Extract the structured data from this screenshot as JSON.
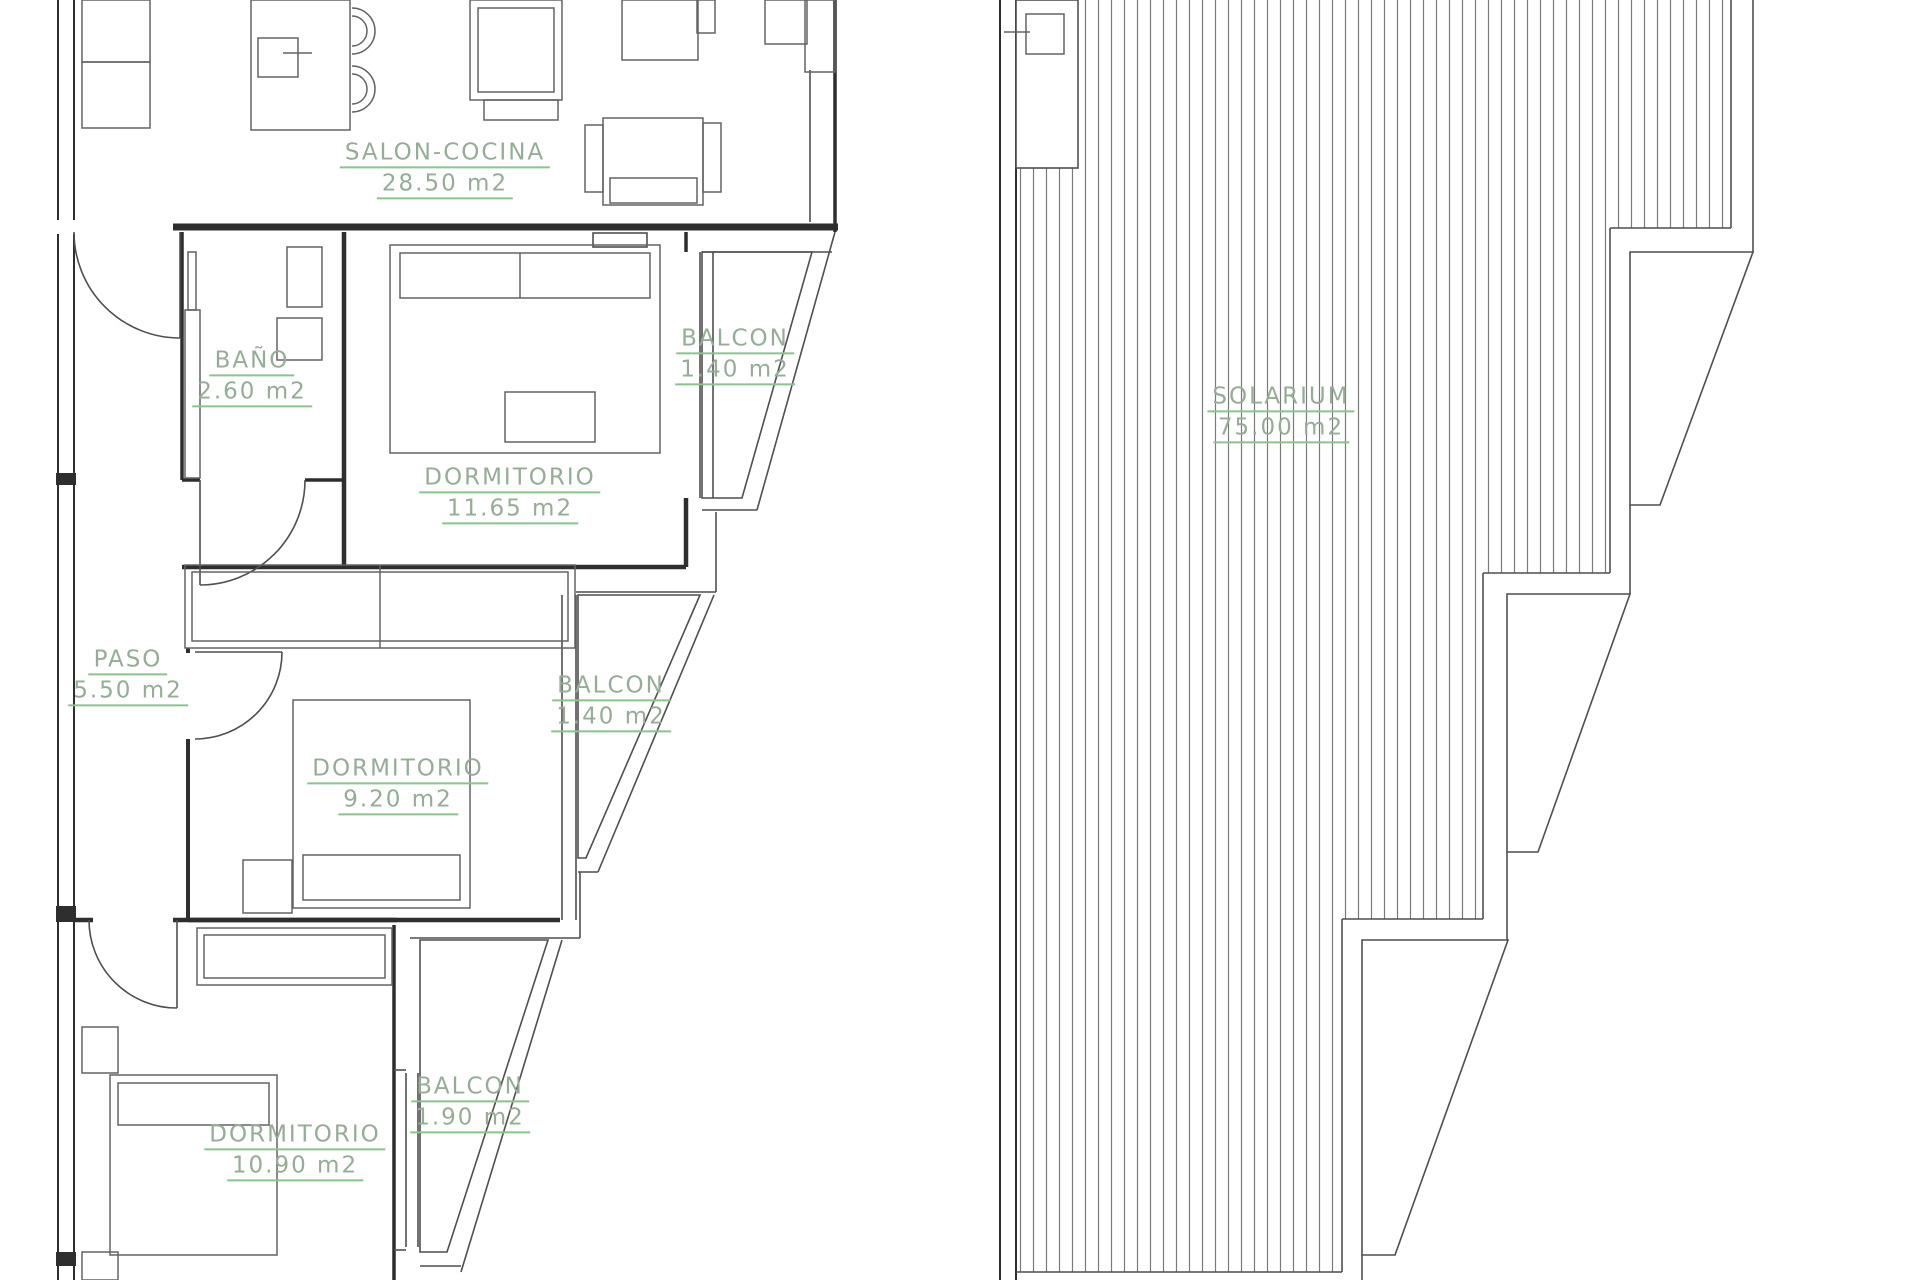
{
  "colors": {
    "label_green": "#8ac48c",
    "label_text": "#95ad95",
    "line_gray": "#4f4f4f",
    "wall_dark": "#2e2e2e",
    "background": "#ffffff"
  },
  "apartment_plan": {
    "salon": {
      "name": "SALON-COCINA",
      "area": "28.50 m2"
    },
    "bathroom": {
      "name": "BAÑO",
      "area": "2.60 m2"
    },
    "bedroom_1": {
      "name": "DORMITORIO",
      "area": "11.65 m2"
    },
    "balcony_1": {
      "name": "BALCON",
      "area": "1.40 m2"
    },
    "hallway": {
      "name": "PASO",
      "area": "5.50 m2"
    },
    "bedroom_2": {
      "name": "DORMITORIO",
      "area": "9.20 m2"
    },
    "balcony_2": {
      "name": "BALCON",
      "area": "1.40 m2"
    },
    "bedroom_3": {
      "name": "DORMITORIO",
      "area": "10.90 m2"
    },
    "balcony_3": {
      "name": "BALCON",
      "area": "1.90 m2"
    }
  },
  "roof_plan": {
    "solarium": {
      "name": "SOLARIUM",
      "area": "75.00 m2"
    }
  }
}
